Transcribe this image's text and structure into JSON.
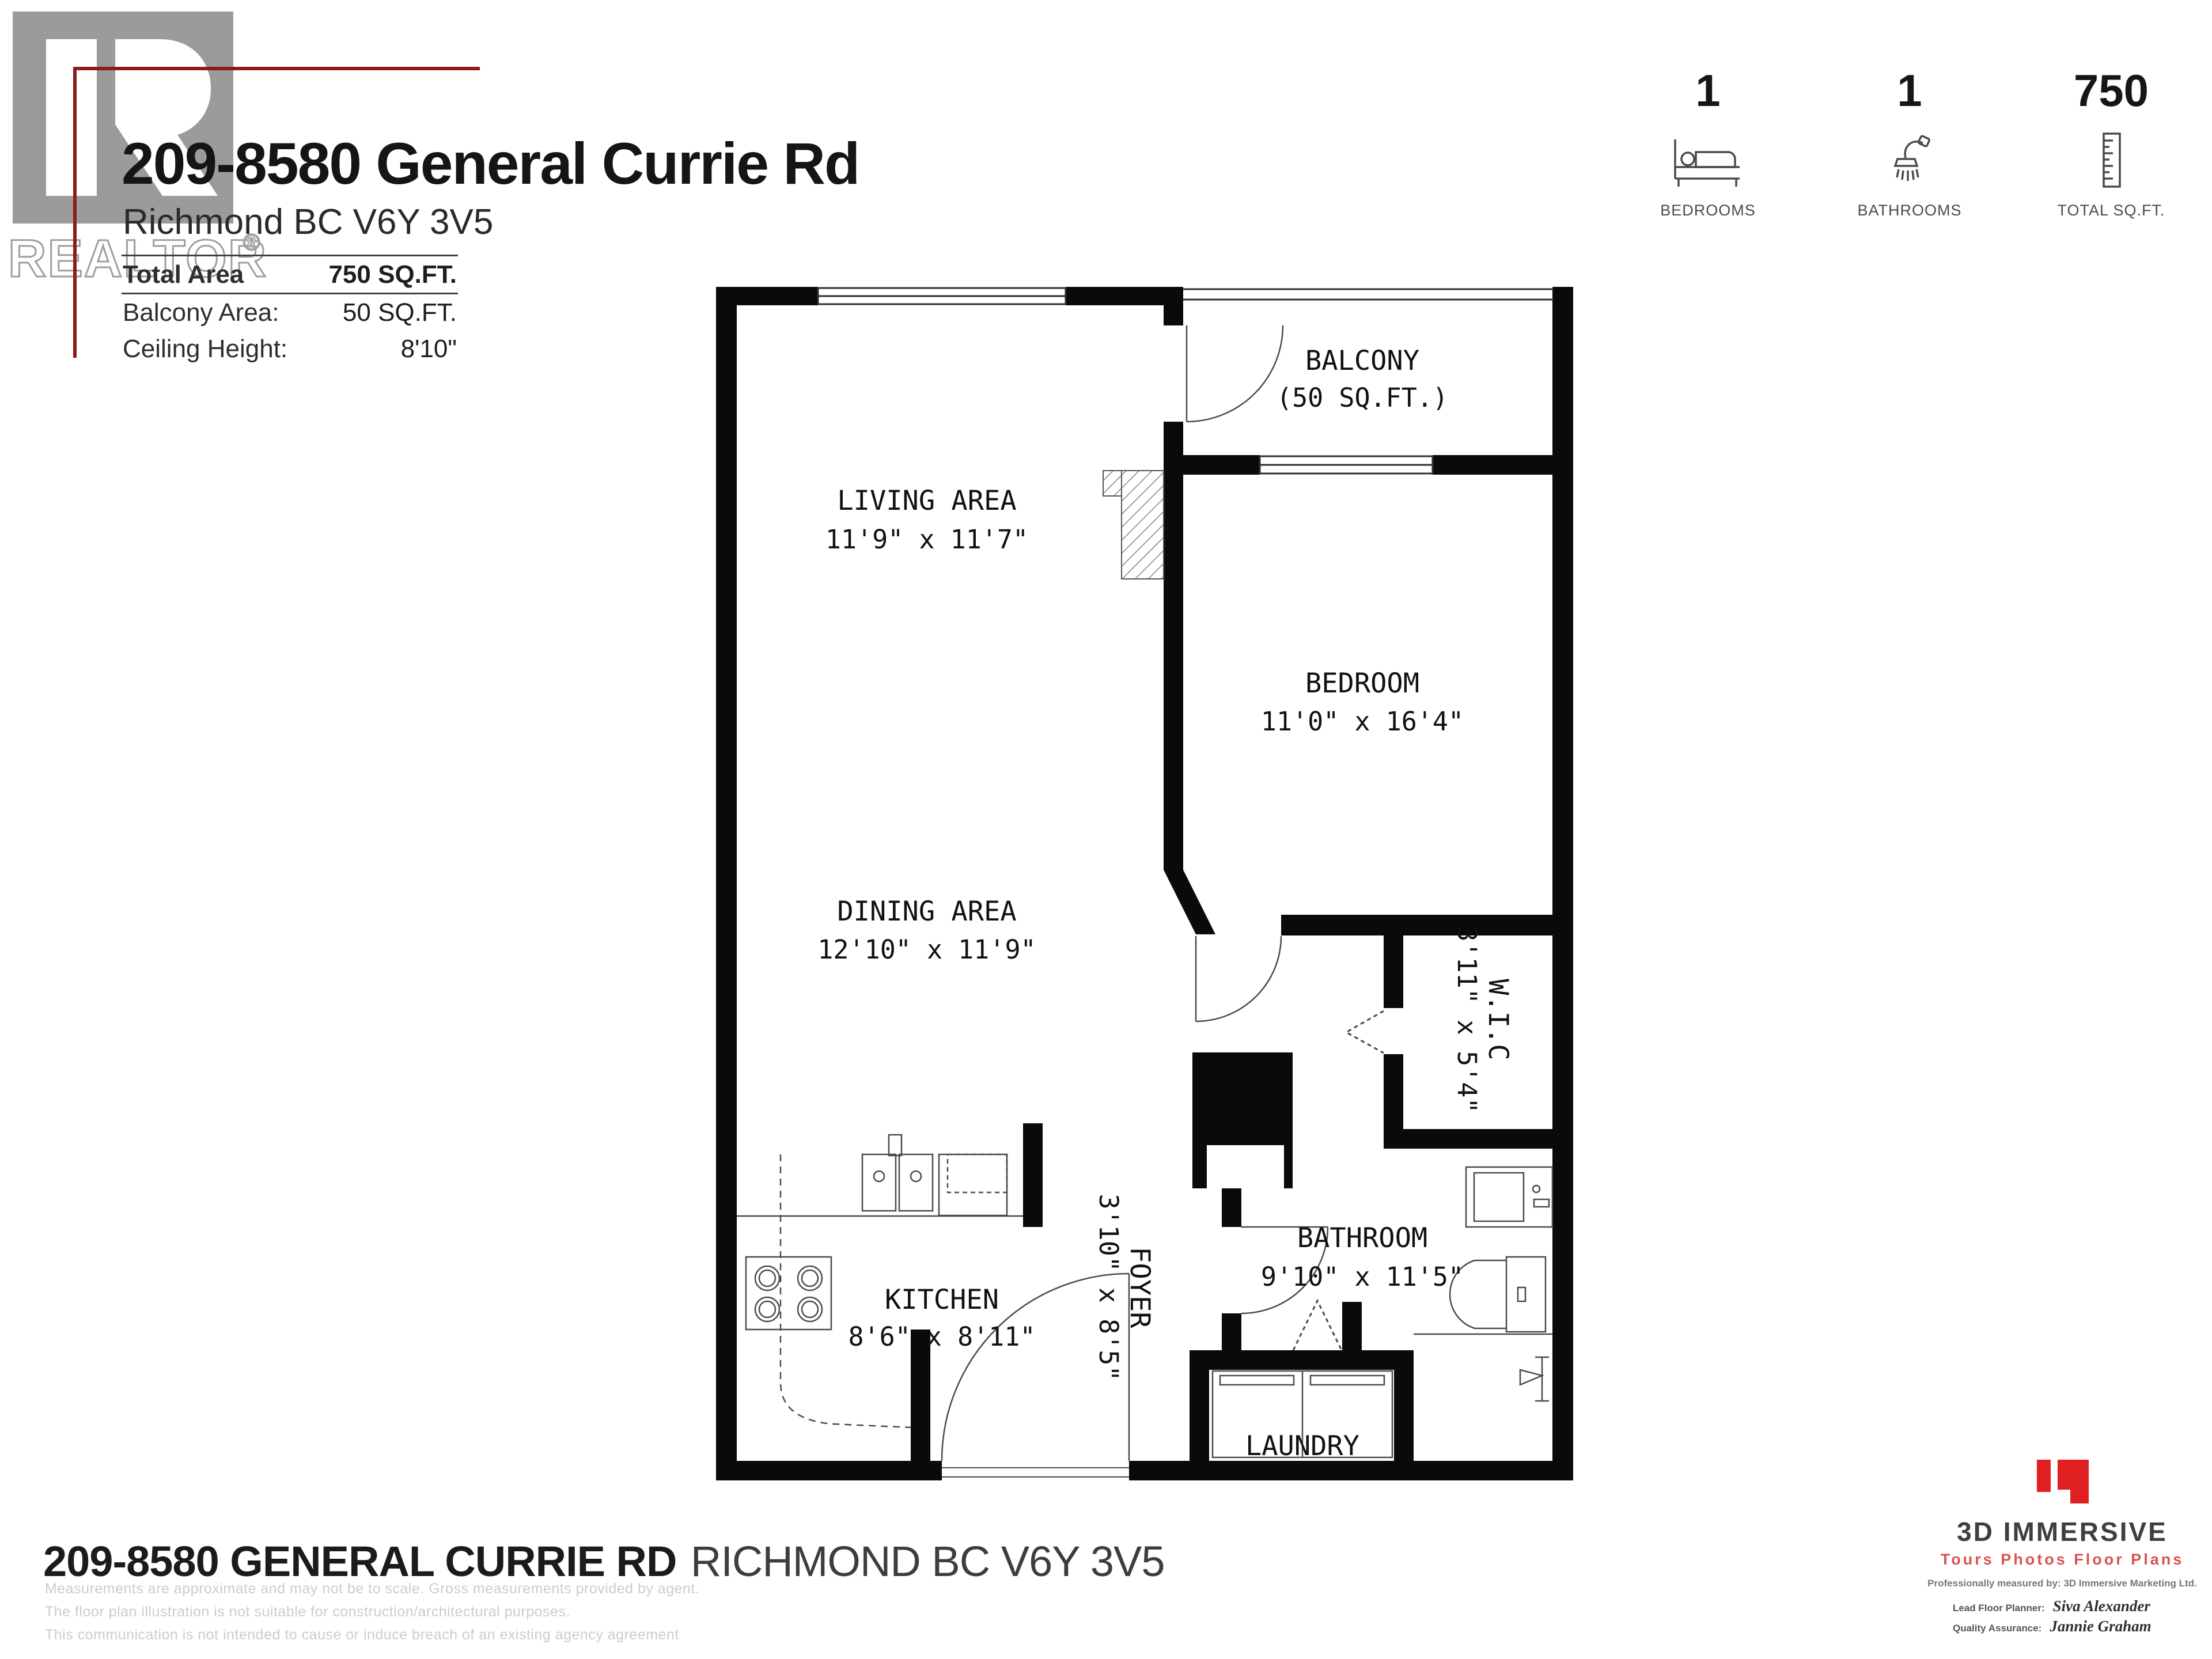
{
  "header": {
    "title": "209-8580 General Currie Rd",
    "subtitle": "Richmond BC V6Y 3V5",
    "realtor_logo": "REALTOR",
    "realtor_reg": "®",
    "info": [
      {
        "label": "Total Area",
        "value": "750 SQ.FT."
      },
      {
        "label": "Balcony Area:",
        "value": "50 SQ.FT."
      },
      {
        "label": "Ceiling Height:",
        "value": "8'10\""
      }
    ]
  },
  "stats": [
    {
      "value": "1",
      "label": "BEDROOMS",
      "icon": "bed-icon"
    },
    {
      "value": "1",
      "label": "BATHROOMS",
      "icon": "shower-icon"
    },
    {
      "value": "750",
      "label": "TOTAL SQ.FT.",
      "icon": "ruler-icon"
    }
  ],
  "floorplan": {
    "rooms": [
      {
        "name": "BALCONY",
        "dims": "(50 SQ.FT.)"
      },
      {
        "name": "LIVING AREA",
        "dims": "11'9\" x 11'7\""
      },
      {
        "name": "BEDROOM",
        "dims": "11'0\" x 16'4\""
      },
      {
        "name": "DINING AREA",
        "dims": "12'10\" x 11'9\""
      },
      {
        "name": "W.I.C",
        "dims": "3'11\" x 5'4\""
      },
      {
        "name": "KITCHEN",
        "dims": "8'6\" x 8'11\""
      },
      {
        "name": "FOYER",
        "dims": "3'10\" x 8'5\""
      },
      {
        "name": "BATHROOM",
        "dims": "9'10\" x 11'5\""
      },
      {
        "name": "LAUNDRY",
        "dims": ""
      }
    ]
  },
  "footer": {
    "address_bold": "209-8580 GENERAL CURRIE RD",
    "address_light": "RICHMOND BC V6Y 3V5",
    "disclaimers": [
      "Measurements are approximate and may not be to scale. Gross measurements provided by agent.",
      "The floor plan illustration is not suitable for construction/architectural purposes.",
      "This communication is not intended to cause or induce breach of an existing agency agreement"
    ]
  },
  "branding": {
    "name": "3D IMMERSIVE",
    "tagline": "Tours  Photos  Floor Plans",
    "measured_by": "Professionally measured by: 3D Immersive Marketing Ltd.",
    "lead_label": "Lead Floor Planner:",
    "lead_name": "Siva Alexander",
    "qa_label": "Quality Assurance:",
    "qa_name": "Jannie Graham"
  },
  "colors": {
    "accent_red": "#8a1c1c",
    "brand_red": "#e02020",
    "logo_gray": "#9b9b9b",
    "wall_black": "#0a0a0a"
  }
}
